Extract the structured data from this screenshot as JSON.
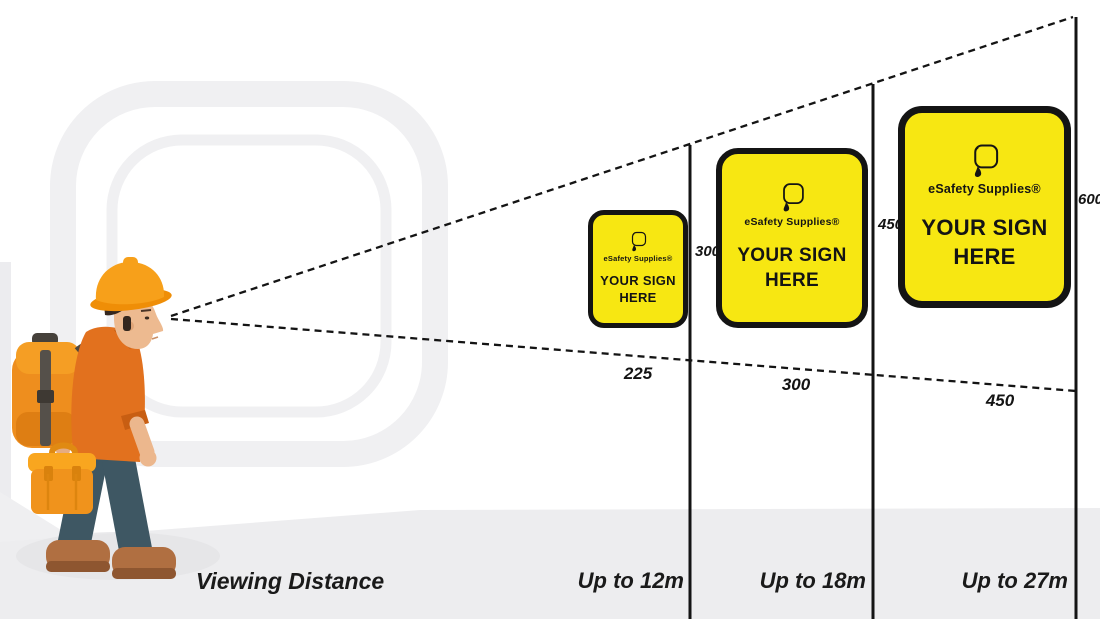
{
  "scene": {
    "viewing_distance_label": "Viewing Distance",
    "sign": {
      "brand": "eSafety Supplies®",
      "title_line1": "YOUR SIGN",
      "title_line2": "HERE"
    },
    "zones": [
      {
        "distance": "Up to 12m",
        "sign_width_mm": "225",
        "sign_height_mm": "300"
      },
      {
        "distance": "Up to 18m",
        "sign_width_mm": "300",
        "sign_height_mm": "450"
      },
      {
        "distance": "Up to 27m",
        "sign_width_mm": "450",
        "sign_height_mm": "600"
      }
    ],
    "colors": {
      "sign_yellow": "#F7E712",
      "sign_border": "#141414",
      "line": "#141414",
      "floor": "#EDEDEF",
      "watermark": "#F0F0F2",
      "worker_orange": "#E2711E",
      "hat_orange": "#F7A01A"
    }
  }
}
